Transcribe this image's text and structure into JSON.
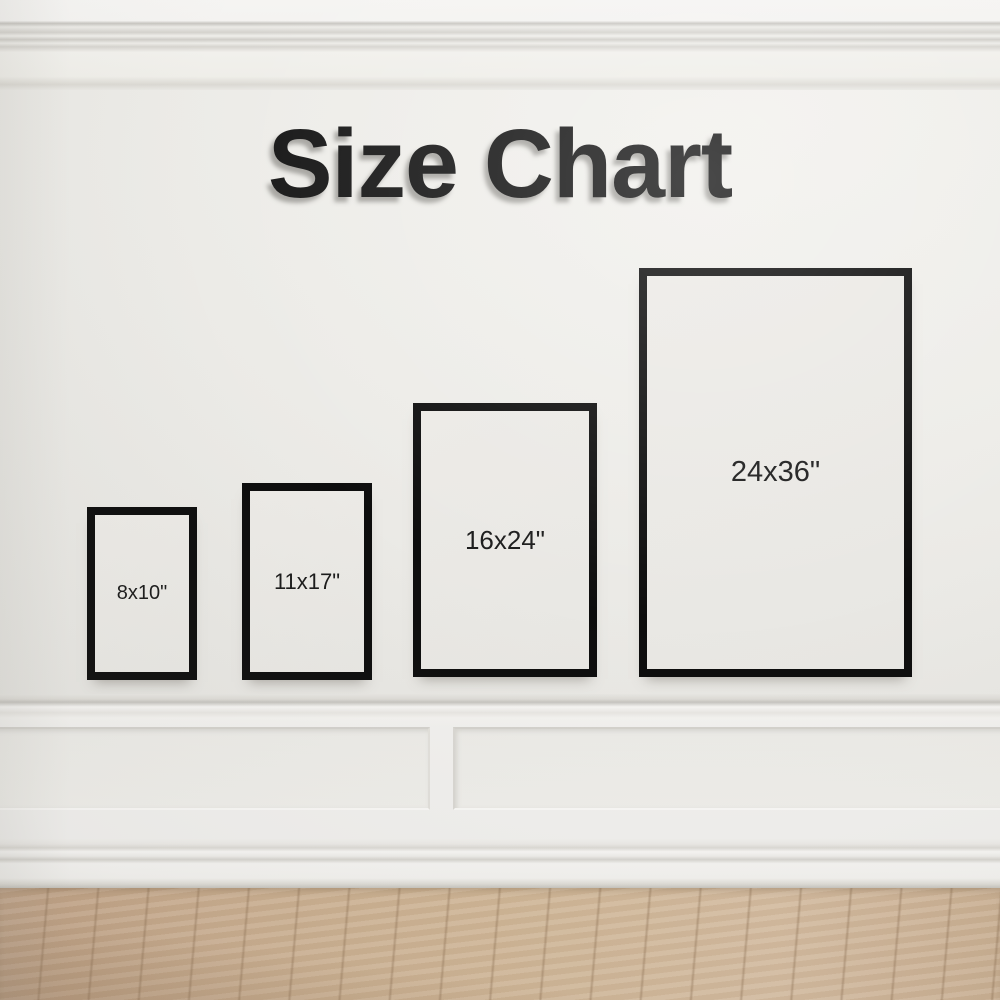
{
  "title": "Size Chart",
  "frames": [
    {
      "id": "8x10",
      "label": "8x10\"",
      "width_in": 8,
      "height_in": 10
    },
    {
      "id": "11x17",
      "label": "11x17\"",
      "width_in": 11,
      "height_in": 17
    },
    {
      "id": "16x24",
      "label": "16x24\"",
      "width_in": 16,
      "height_in": 24
    },
    {
      "id": "24x36",
      "label": "24x36\"",
      "width_in": 24,
      "height_in": 36
    }
  ],
  "colors": {
    "wall": "#eae9e5",
    "wainscot": "#f1f0ee",
    "frame_border": "#0d0d0d",
    "title_text": "#161616",
    "label_text": "#1b1b1b",
    "floor_wood": "#cfb394"
  }
}
